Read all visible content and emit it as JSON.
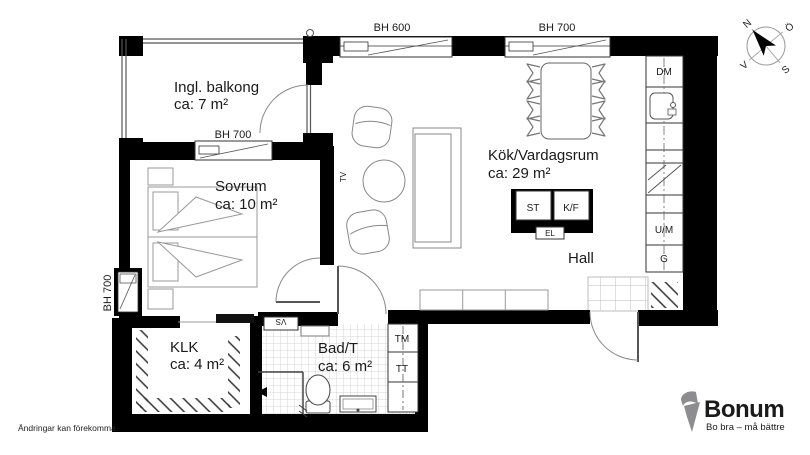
{
  "disclaimer": "Ändringar kan förekomma.",
  "brand": {
    "name": "Bonum",
    "tagline": "Bo bra – må bättre",
    "orange": "#EF7D00",
    "gray": "#8D8D90"
  },
  "compass": {
    "north": "N",
    "east": "Ö",
    "south": "S",
    "west": "V"
  },
  "rooms": {
    "balcony": {
      "name": "Ingl. balkong",
      "area": "ca: 7 m²"
    },
    "bedroom": {
      "name": "Sovrum",
      "area": "ca: 10 m²"
    },
    "kitchen_living": {
      "name": "Kök/Vardagsrum",
      "area": "ca: 29 m²"
    },
    "hall": {
      "name": "Hall"
    },
    "closet": {
      "name": "KLK",
      "area": "ca: 4 m²"
    },
    "bathroom": {
      "name": "Bad/T",
      "area": "ca: 6 m²"
    }
  },
  "windows": {
    "kitchen_left": "BH 600",
    "kitchen_right": "BH 700",
    "bedroom_top": "BH 700",
    "bedroom_left": "BH 700"
  },
  "fixtures": {
    "dishwasher": "DM",
    "cleaning_cabinet": "ST",
    "fridge_freezer": "K/F",
    "electrical": "EL",
    "oven_micro": "U/M",
    "wardrobe": "G",
    "washer": "TM",
    "dryer": "TT",
    "water_heater": "VS",
    "tv": "TV"
  }
}
